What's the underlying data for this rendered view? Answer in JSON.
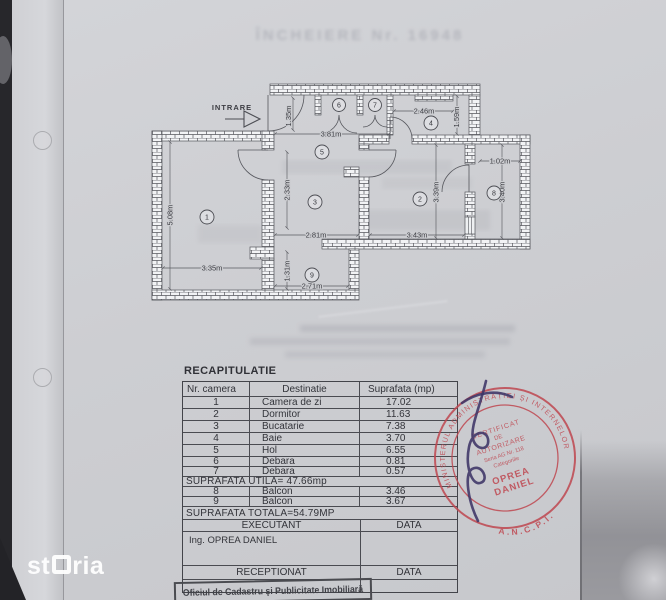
{
  "watermark": "storia",
  "faint_title": "ÎNCHEIERE Nr. 16948",
  "plan": {
    "entrance": "INTRARE",
    "rooms": {
      "r1": "1",
      "r2": "2",
      "r3": "3",
      "r4": "4",
      "r5": "5",
      "r6": "6",
      "r7": "7",
      "r8": "8",
      "r9": "9"
    },
    "dims": {
      "d381": "3.81m",
      "d135": "1.35m",
      "d246": "2.46m",
      "d159": "1.59m",
      "d102": "1.02m",
      "d340": "3.40m",
      "d339": "3.39m",
      "d343": "3.43m",
      "d281": "2.81m",
      "d233": "2.33m",
      "d508": "5.08m",
      "d335": "3.35m",
      "d131": "1.31m",
      "d271": "2.71m"
    }
  },
  "table": {
    "title": "RECAPITULATIE",
    "headers": [
      "Nr. camera",
      "Destinatie",
      "Suprafata (mp)"
    ],
    "rows": [
      [
        "1",
        "Camera de zi",
        "17.02"
      ],
      [
        "2",
        "Dormitor",
        "11.63"
      ],
      [
        "3",
        "Bucatarie",
        "7.38"
      ],
      [
        "4",
        "Baie",
        "3.70"
      ],
      [
        "5",
        "Hol",
        "6.55"
      ],
      [
        "6",
        "Debara",
        "0.81"
      ],
      [
        "7",
        "Debara",
        "0.57"
      ]
    ],
    "useful_area": "SUPRAFATA UTILA= 47.66mp",
    "balcony_rows": [
      [
        "8",
        "Balcon",
        "3.46"
      ],
      [
        "9",
        "Balcon",
        "3.67"
      ]
    ],
    "total_area": "SUPRAFATA TOTALA=54.79MP",
    "executant_label": "EXECUTANT",
    "data_label": "DATA",
    "executant_name": "Ing. OPREA DANIEL",
    "receptionat_label": "RECEPTIONAT",
    "receptionat_data_label": "DATA"
  },
  "stamp": {
    "ring_text": "MINISTERUL ADMINISTRAȚIEI ȘI INTERNELOR",
    "ring_bottom": "A.N.C.P.I.",
    "line1": "CERTIFICAT",
    "line2": "DE",
    "line3": "AUTORIZARE",
    "line4": "Seria AG Nr. 118",
    "line5": "Categoriile",
    "name_line1": "OPREA",
    "name_line2": "DANIEL"
  },
  "footer_stamp": "Oficiul de Cadastru şi Publicitate Imobiliară"
}
